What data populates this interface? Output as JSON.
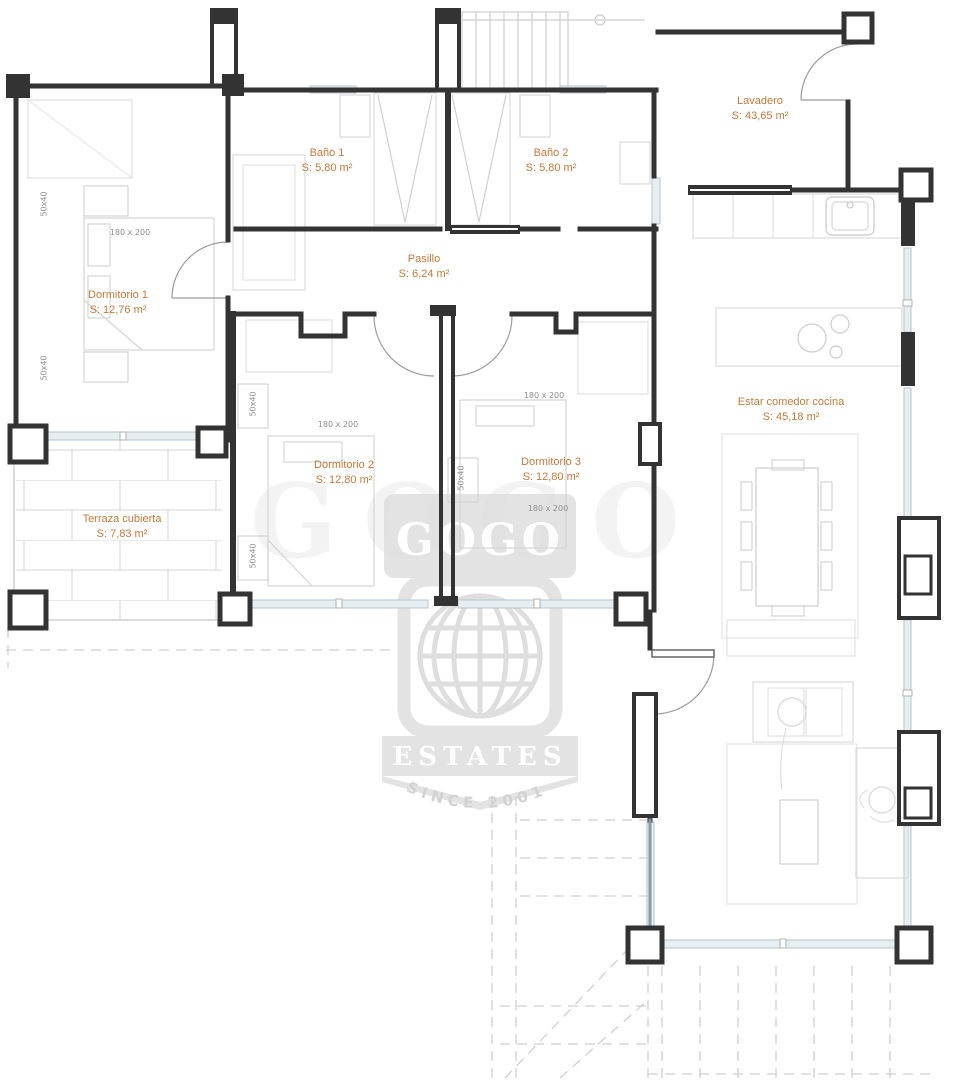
{
  "rooms": {
    "bano1": {
      "name": "Baño 1",
      "area": "S: 5,80 m²"
    },
    "bano2": {
      "name": "Baño 2",
      "area": "S: 5,80 m²"
    },
    "lavadero": {
      "name": "Lavadero",
      "area": "S: 43,65 m²"
    },
    "dormitorio1": {
      "name": "Dormitorio 1",
      "area": "S: 12,76 m²"
    },
    "pasillo": {
      "name": "Pasillo",
      "area": "S: 6,24 m²"
    },
    "dormitorio2": {
      "name": "Dormitorio 2",
      "area": "S: 12,80 m²"
    },
    "dormitorio3": {
      "name": "Dormitorio 3",
      "area": "S: 12,80 m²"
    },
    "estar": {
      "name": "Estar comedor cocina",
      "area": "S: 45,18 m²"
    },
    "terraza": {
      "name": "Terraza cubierta",
      "area": "S: 7,83 m²"
    }
  },
  "furniture_labels": {
    "bed_size": "180 x 200",
    "nightstand_size": "50x40"
  },
  "watermark": {
    "brand": "GOGO",
    "line2": "ESTATES",
    "line3": "SINCE 2001"
  },
  "colors": {
    "label_orange": "#c4793c",
    "wall_black": "#333333",
    "furniture_gray": "#d2d2d2",
    "window_blue": "#dde8ee",
    "watermark_gray": "#dcdcdc"
  }
}
